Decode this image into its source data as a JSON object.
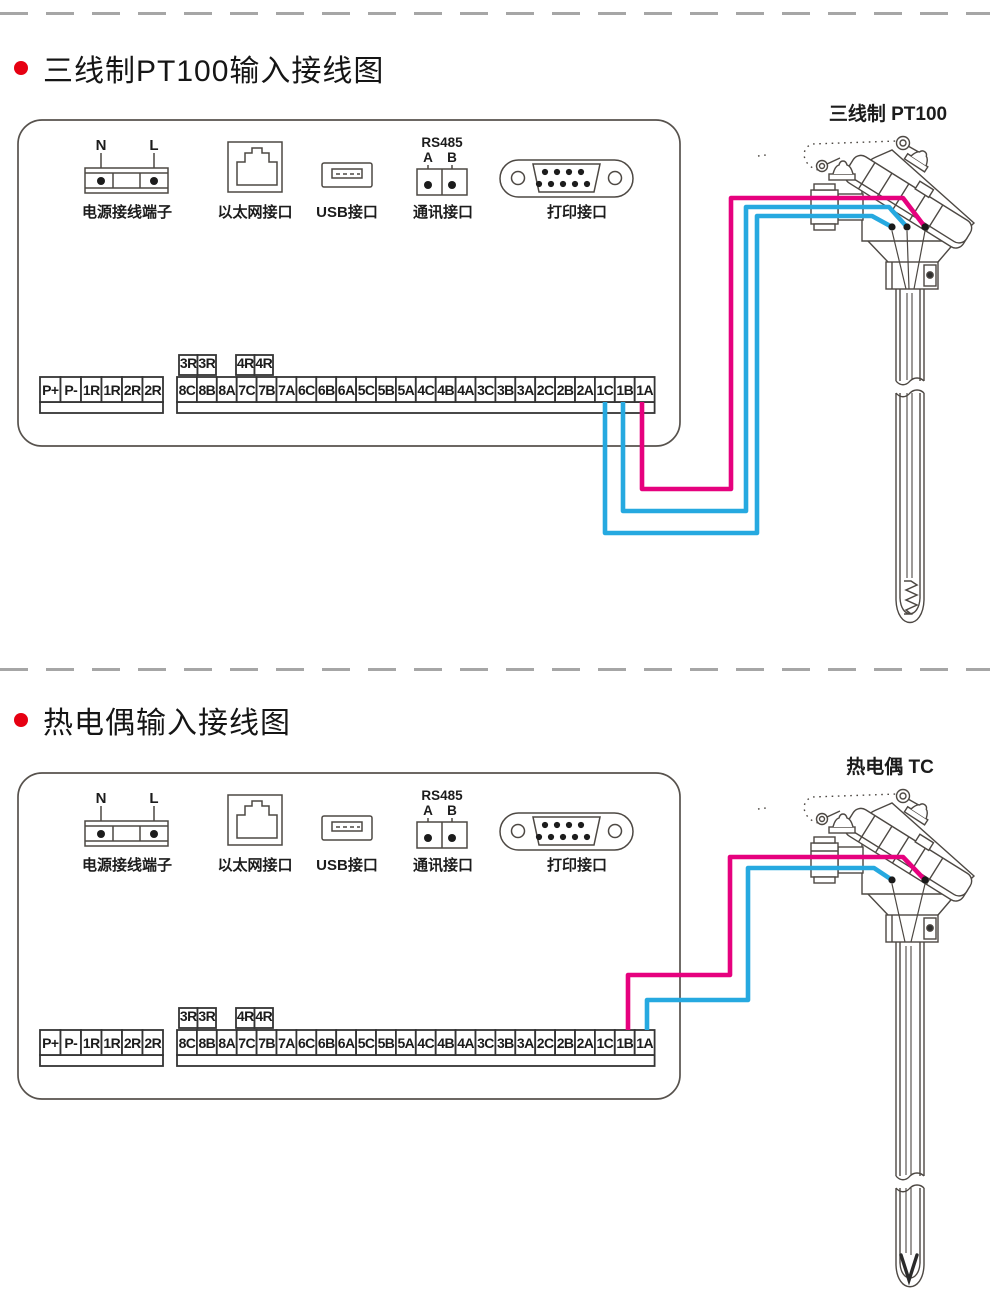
{
  "sections": [
    {
      "title": "三线制PT100输入接线图",
      "sensor_label": "三线制 PT100",
      "sensor_type": "pt100",
      "wires": [
        {
          "from_terminal": "1C",
          "color_name": "blue",
          "color": "#26a9e0",
          "points": [
            [
              605,
              402
            ],
            [
              605,
              533
            ],
            [
              757,
              533
            ],
            [
              757,
              216
            ],
            [
              872,
              216
            ],
            [
              892,
              227
            ]
          ]
        },
        {
          "from_terminal": "1B",
          "color_name": "blue",
          "color": "#26a9e0",
          "points": [
            [
              623,
              402
            ],
            [
              623,
              511
            ],
            [
              746,
              511
            ],
            [
              746,
              207
            ],
            [
              889,
              207
            ],
            [
              907,
              227
            ]
          ]
        },
        {
          "from_terminal": "1A",
          "color_name": "magenta",
          "color": "#e6017e",
          "points": [
            [
              642,
              402
            ],
            [
              642,
              489
            ],
            [
              731,
              489
            ],
            [
              731,
              198
            ],
            [
              903,
              198
            ],
            [
              925,
              227
            ]
          ]
        }
      ],
      "sensor_terminals": [
        [
          892,
          227
        ],
        [
          907,
          227
        ],
        [
          925,
          227
        ]
      ]
    },
    {
      "title": "热电偶输入接线图",
      "sensor_label": "热电偶 TC",
      "sensor_type": "tc",
      "wires": [
        {
          "from_terminal": "1A",
          "color_name": "blue",
          "color": "#26a9e0",
          "points": [
            [
              647,
              377
            ],
            [
              647,
              347
            ],
            [
              748,
              347
            ],
            [
              748,
              215
            ],
            [
              874,
              215
            ],
            [
              892,
              227
            ]
          ]
        },
        {
          "from_terminal": "1B",
          "color_name": "magenta",
          "color": "#e6017e",
          "points": [
            [
              628,
              377
            ],
            [
              628,
              322
            ],
            [
              730,
              322
            ],
            [
              730,
              204
            ],
            [
              903,
              204
            ],
            [
              925,
              227
            ]
          ]
        }
      ],
      "sensor_terminals": [
        [
          892,
          227
        ],
        [
          925,
          227
        ]
      ]
    }
  ],
  "device": {
    "power_n": "N",
    "power_l": "L",
    "power_label": "电源接线端子",
    "ethernet_label": "以太网接口",
    "usb_label": "USB接口",
    "rs485_title": "RS485",
    "rs485_a": "A",
    "rs485_b": "B",
    "comm_label": "通讯接口",
    "printer_label": "打印接口",
    "terminals_left": [
      "P+",
      "P-",
      "1R",
      "1R",
      "2R",
      "2R"
    ],
    "relay_terminals": [
      "3R",
      "3R",
      "4R",
      "4R"
    ],
    "terminals_main": [
      "8C",
      "8B",
      "8A",
      "7C",
      "7B",
      "7A",
      "6C",
      "6B",
      "6A",
      "5C",
      "5B",
      "5A",
      "4C",
      "4B",
      "4A",
      "3C",
      "3B",
      "3A",
      "2C",
      "2B",
      "2A",
      "1C",
      "1B",
      "1A"
    ]
  },
  "colors": {
    "bullet_red": "#e60012",
    "wire_magenta": "#e6017e",
    "wire_blue": "#26a9e0",
    "separator_gray": "#a6a6a6"
  }
}
